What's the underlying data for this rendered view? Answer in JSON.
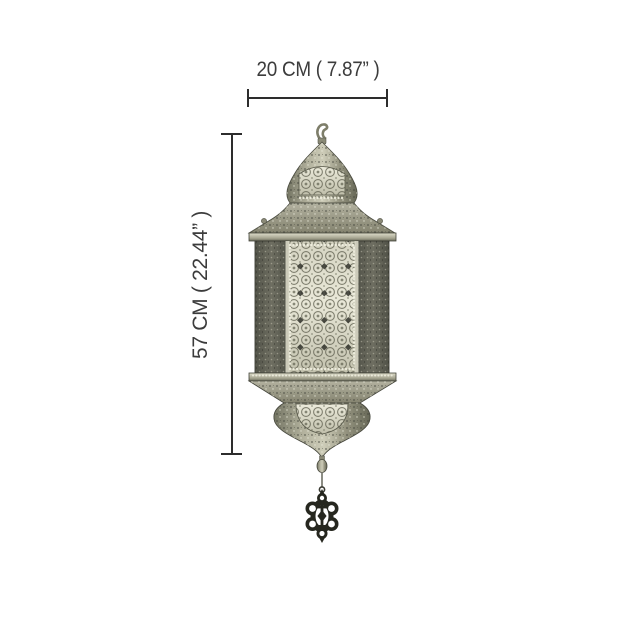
{
  "canvas": {
    "background": "#ffffff",
    "width_px": 640,
    "height_px": 640
  },
  "subject": {
    "name": "Moroccan pierced-metal hanging lantern",
    "parts": [
      "hanging hook",
      "onion dome",
      "filigree arch panel",
      "hexagonal roof",
      "hexagonal filigree body",
      "tapered base",
      "bell bottom",
      "finial knob",
      "openwork pendant drop"
    ]
  },
  "dimensions": {
    "width": {
      "label": "20 CM ( 7.87”  )",
      "cm": 20,
      "inches": 7.87
    },
    "height": {
      "label": "57 CM ( 22.44”  )",
      "cm": 57,
      "inches": 22.44
    }
  },
  "annotation_style": {
    "line_color": "#2d2d2d",
    "text_color": "#3c3c3c"
  },
  "palette": {
    "metal_light": "#e8e7d7",
    "metal_mid": "#a3a28e",
    "metal_dark": "#5b5c50",
    "hole_dark": "#35362e",
    "pendant_dark": "#26271f"
  }
}
